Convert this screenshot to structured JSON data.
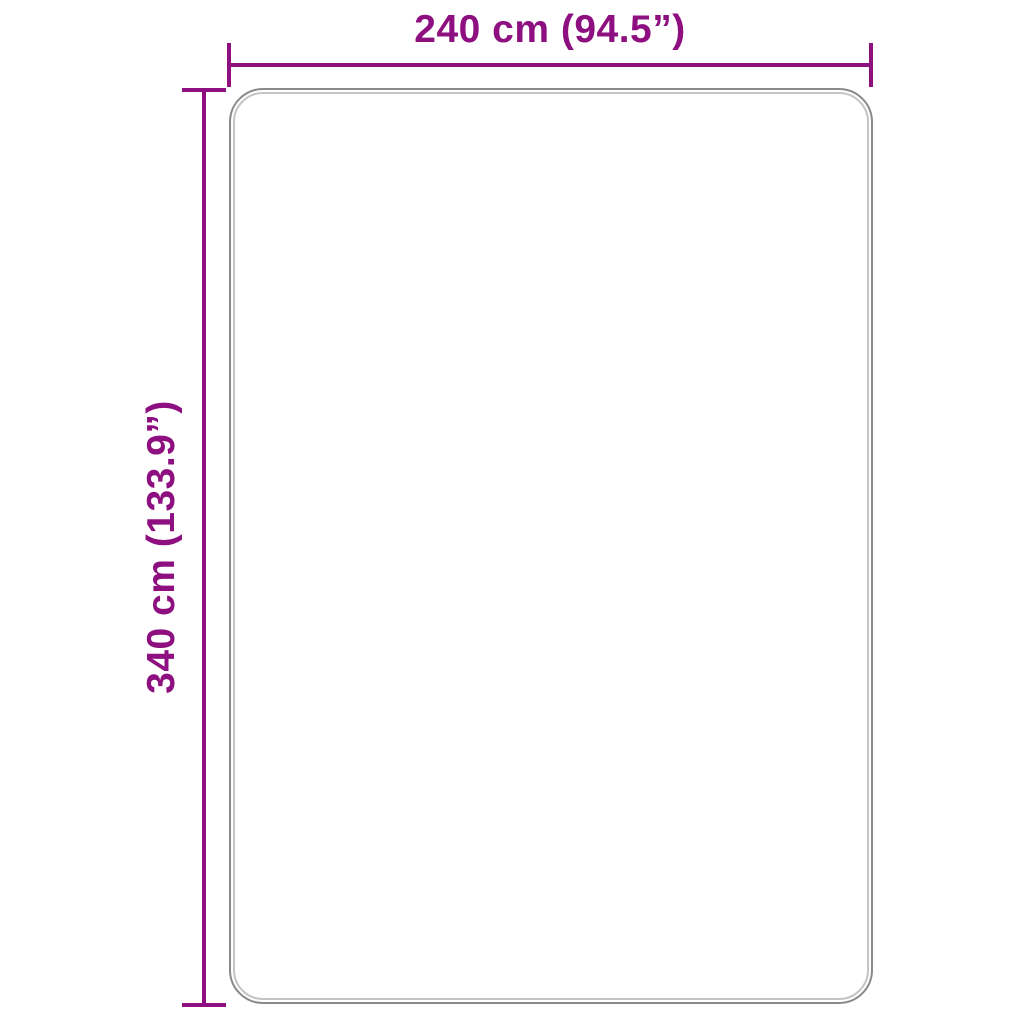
{
  "diagram": {
    "type": "product-dimension-diagram",
    "shape": "rounded-rectangle",
    "width_dimension": {
      "label": "240 cm (94.5”)",
      "value_cm": 240,
      "value_inches": 94.5
    },
    "height_dimension": {
      "label": "340 cm (133.9”)",
      "value_cm": 340,
      "value_inches": 133.9
    }
  },
  "colors": {
    "dimension-accent": "#8e1080",
    "outline-outer": "#8a8a8a",
    "outline-inner": "#c4c4c4",
    "background": "#ffffff"
  }
}
